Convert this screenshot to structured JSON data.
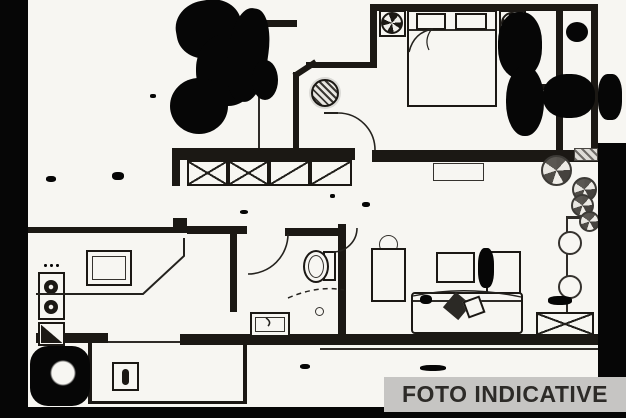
{
  "banner": {
    "label": "FOTO INDICATIVE"
  },
  "palette": {
    "paper": "#f7f6f2",
    "ink": "#1b1814",
    "noise": "#060606",
    "banner-bg": "#c6c5c3",
    "banner-fg": "#2d2b28"
  },
  "symbols": [
    "double-bed",
    "pillow",
    "nightstand-lamp",
    "ceiling-light",
    "wardrobe-hatched-boxes",
    "door-swing-arc",
    "plant",
    "kitchen-sink",
    "cooktop-burners",
    "corner-cabinet",
    "toilet",
    "bathroom-sink",
    "shower-knob",
    "sofa-with-cushions",
    "coffee-table",
    "cabinet",
    "radiator",
    "balcony-stool",
    "storage-xbox",
    "scan-noise"
  ]
}
